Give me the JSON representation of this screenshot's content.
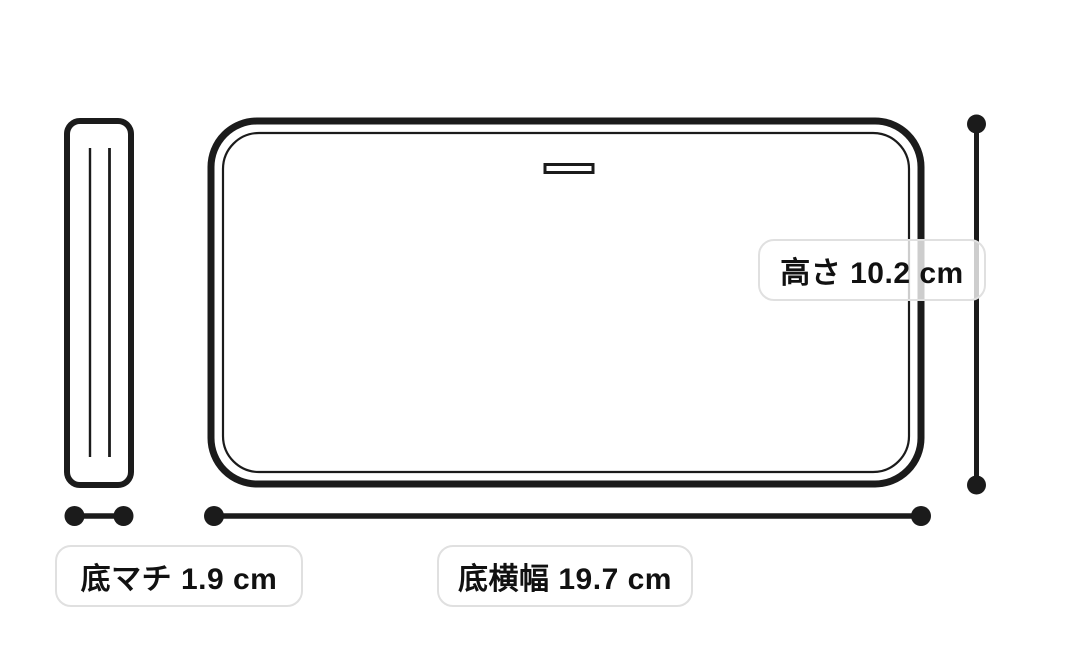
{
  "page": {
    "background_color": "#ffffff",
    "description": "Product dimension diagram of a flat pouch: side (gusset) view and front view with measurement callouts"
  },
  "diagram": {
    "stroke_color": "#1b1b1b",
    "label_border_color": "#e0e0e0",
    "label_background": "rgba(255,255,255,0.78)",
    "text_color": "#111111",
    "views": {
      "side_view": "thin vertical rounded rectangle with two seam lines",
      "front_view": "large rounded rectangle with inner stitch outline and zipper slit"
    },
    "dimensions": {
      "height": {
        "name": "高さ",
        "value": 10.2,
        "unit": "cm",
        "text": "高さ 10.2 cm"
      },
      "bottom_width": {
        "name": "底横幅",
        "value": 19.7,
        "unit": "cm",
        "text": "底横幅 19.7 cm"
      },
      "bottom_gusset": {
        "name": "底マチ",
        "value": 1.9,
        "unit": "cm",
        "text": "底マチ 1.9 cm"
      }
    }
  }
}
